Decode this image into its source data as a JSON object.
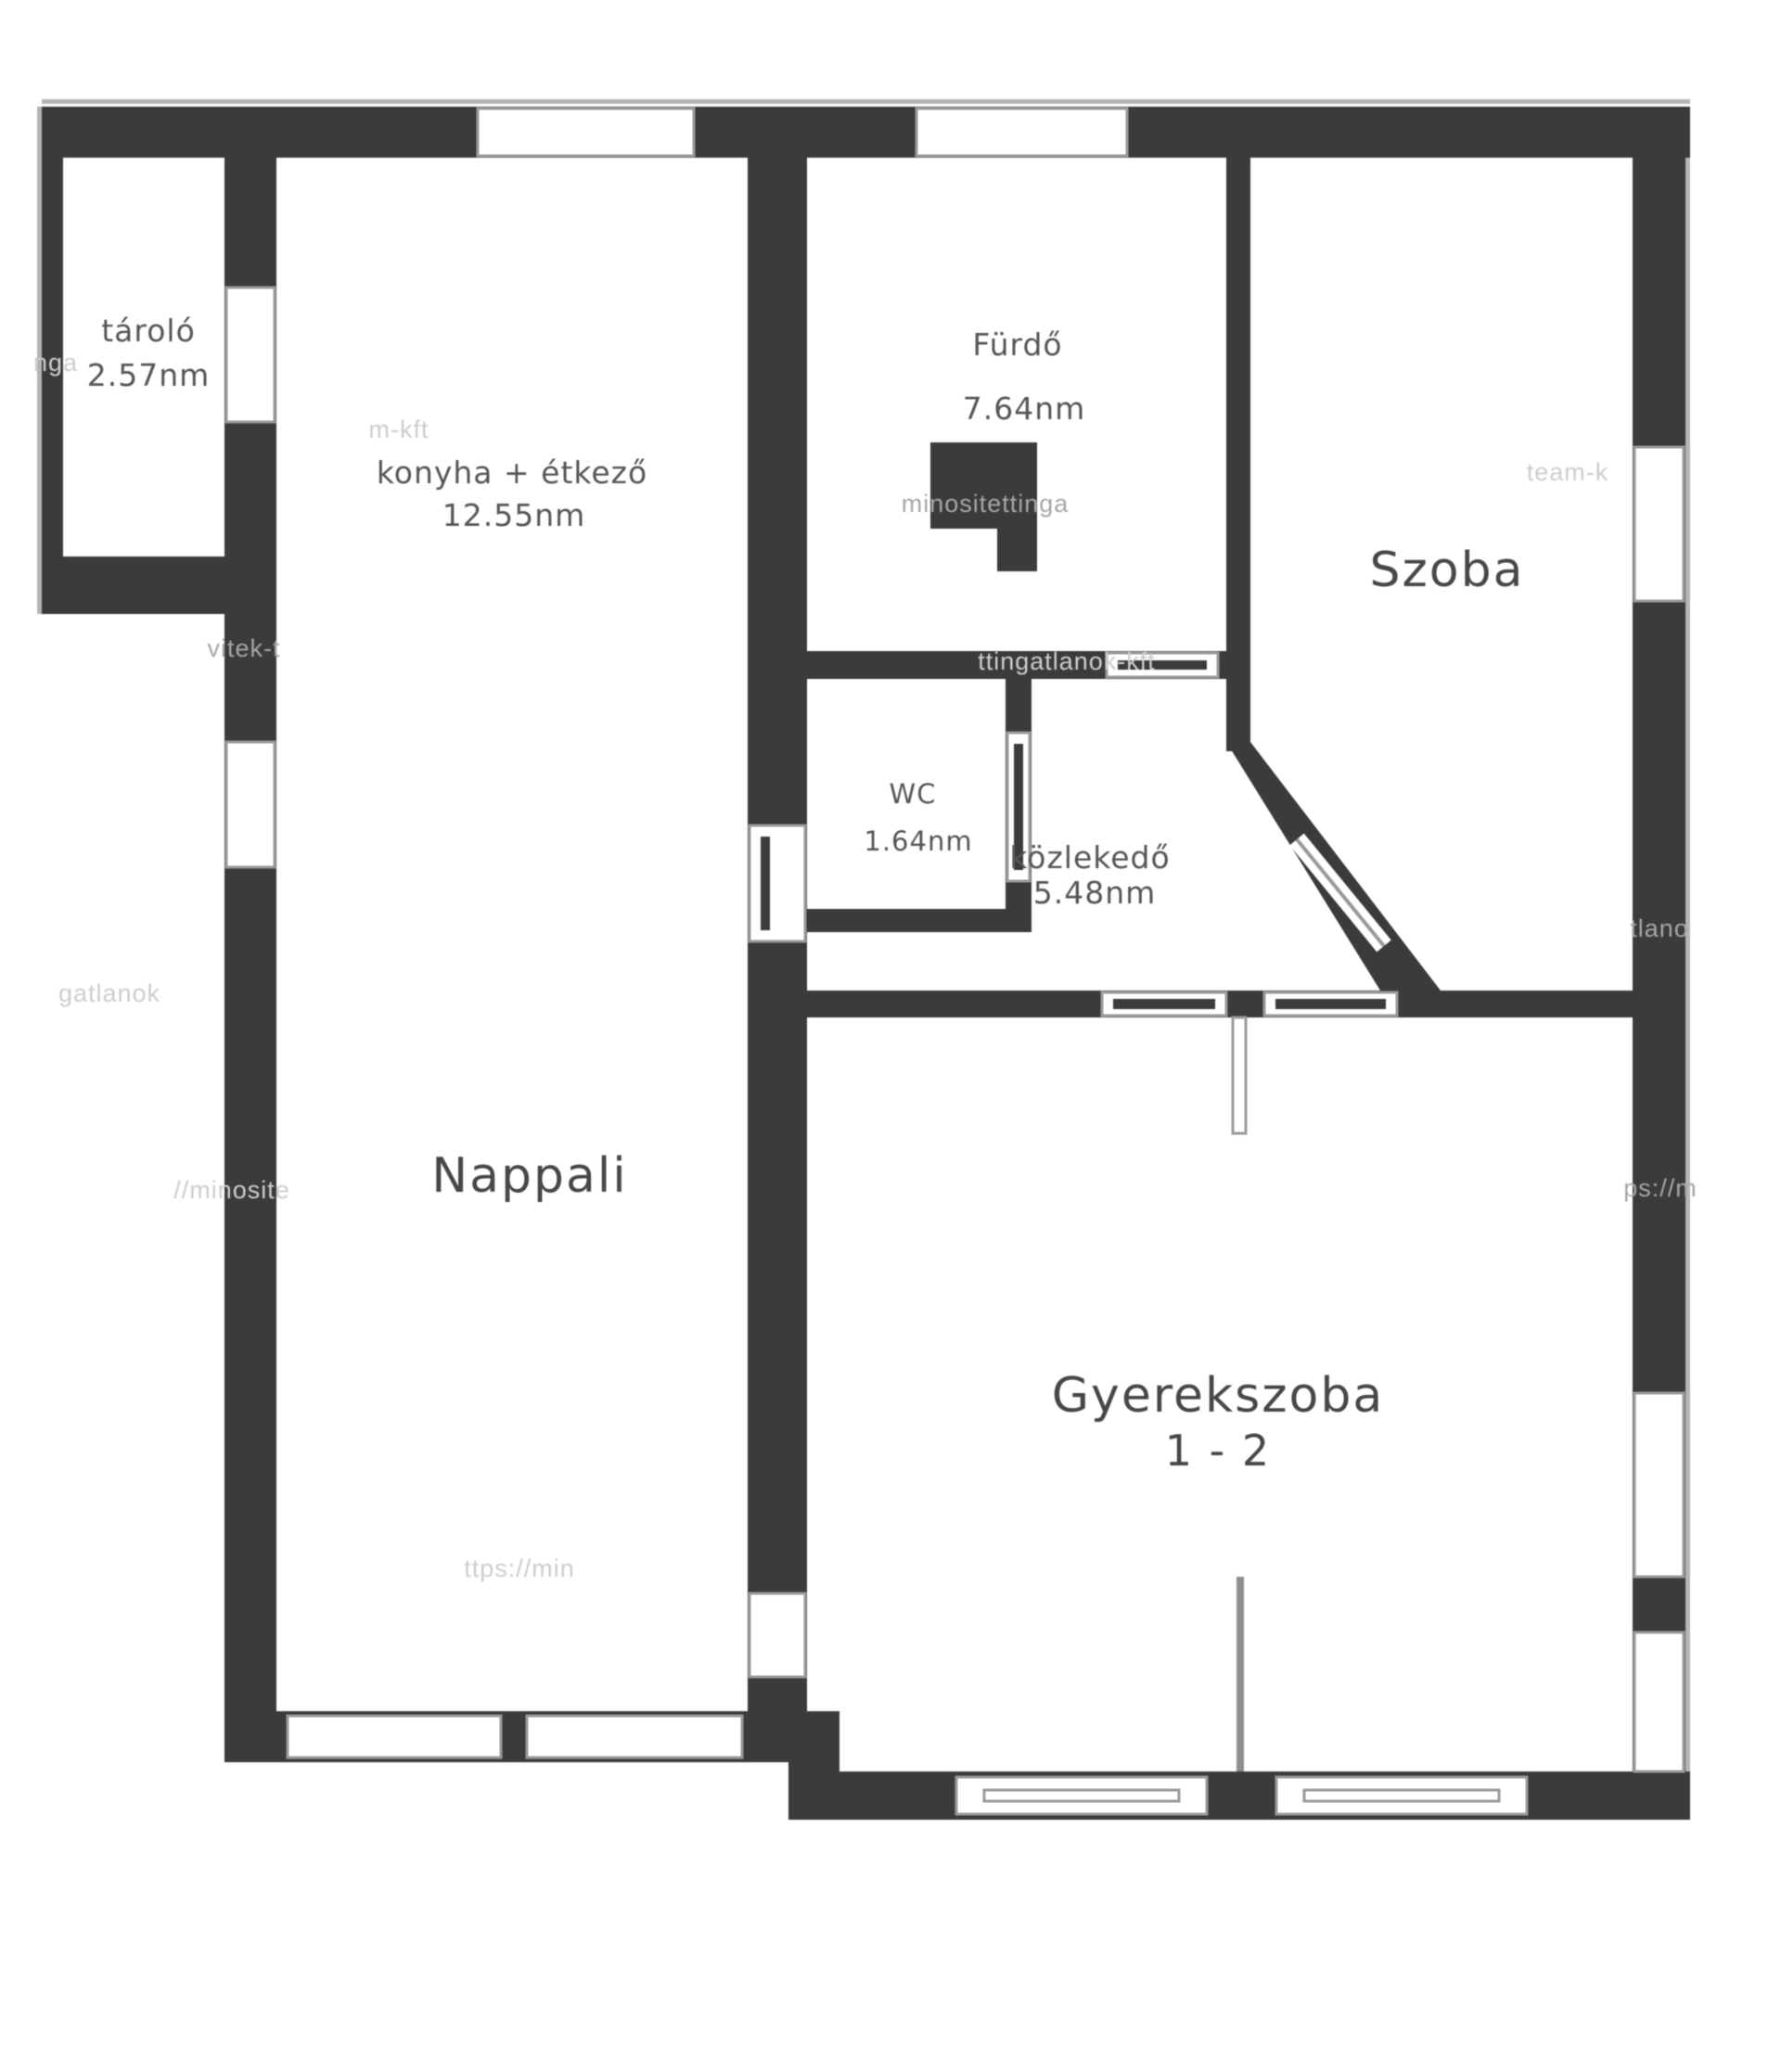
{
  "plan": {
    "type": "apartment-floor-plan",
    "colors": {
      "wall": "#3b3b3c",
      "bg": "#ffffff",
      "frame": "#9a9a9a",
      "label": "#565656",
      "watermark": "#cdcdcd"
    },
    "rooms": {
      "tarolo": {
        "name": "tároló",
        "area": "2.57nm"
      },
      "konyha": {
        "name": "konyha + étkező",
        "area": "12.55nm"
      },
      "furdo": {
        "name": "Fürdő",
        "area": "7.64nm"
      },
      "wc": {
        "name": "WC",
        "area": "1.64nm"
      },
      "kozlekedo": {
        "name": "közlekedő",
        "area": "5.48nm"
      },
      "szoba": {
        "name": "Szoba"
      },
      "nappali": {
        "name": "Nappali"
      },
      "gyerekszoba": {
        "name": "Gyerekszoba",
        "subtitle": "1 - 2"
      }
    },
    "watermarks": [
      "nga",
      "m-kft",
      "minositettinga",
      "team-k",
      "vitek-t",
      "ttingatlanok-kft",
      "//minosite",
      "gatlanok",
      "ps://m",
      "tlano",
      "ttps://min"
    ]
  }
}
